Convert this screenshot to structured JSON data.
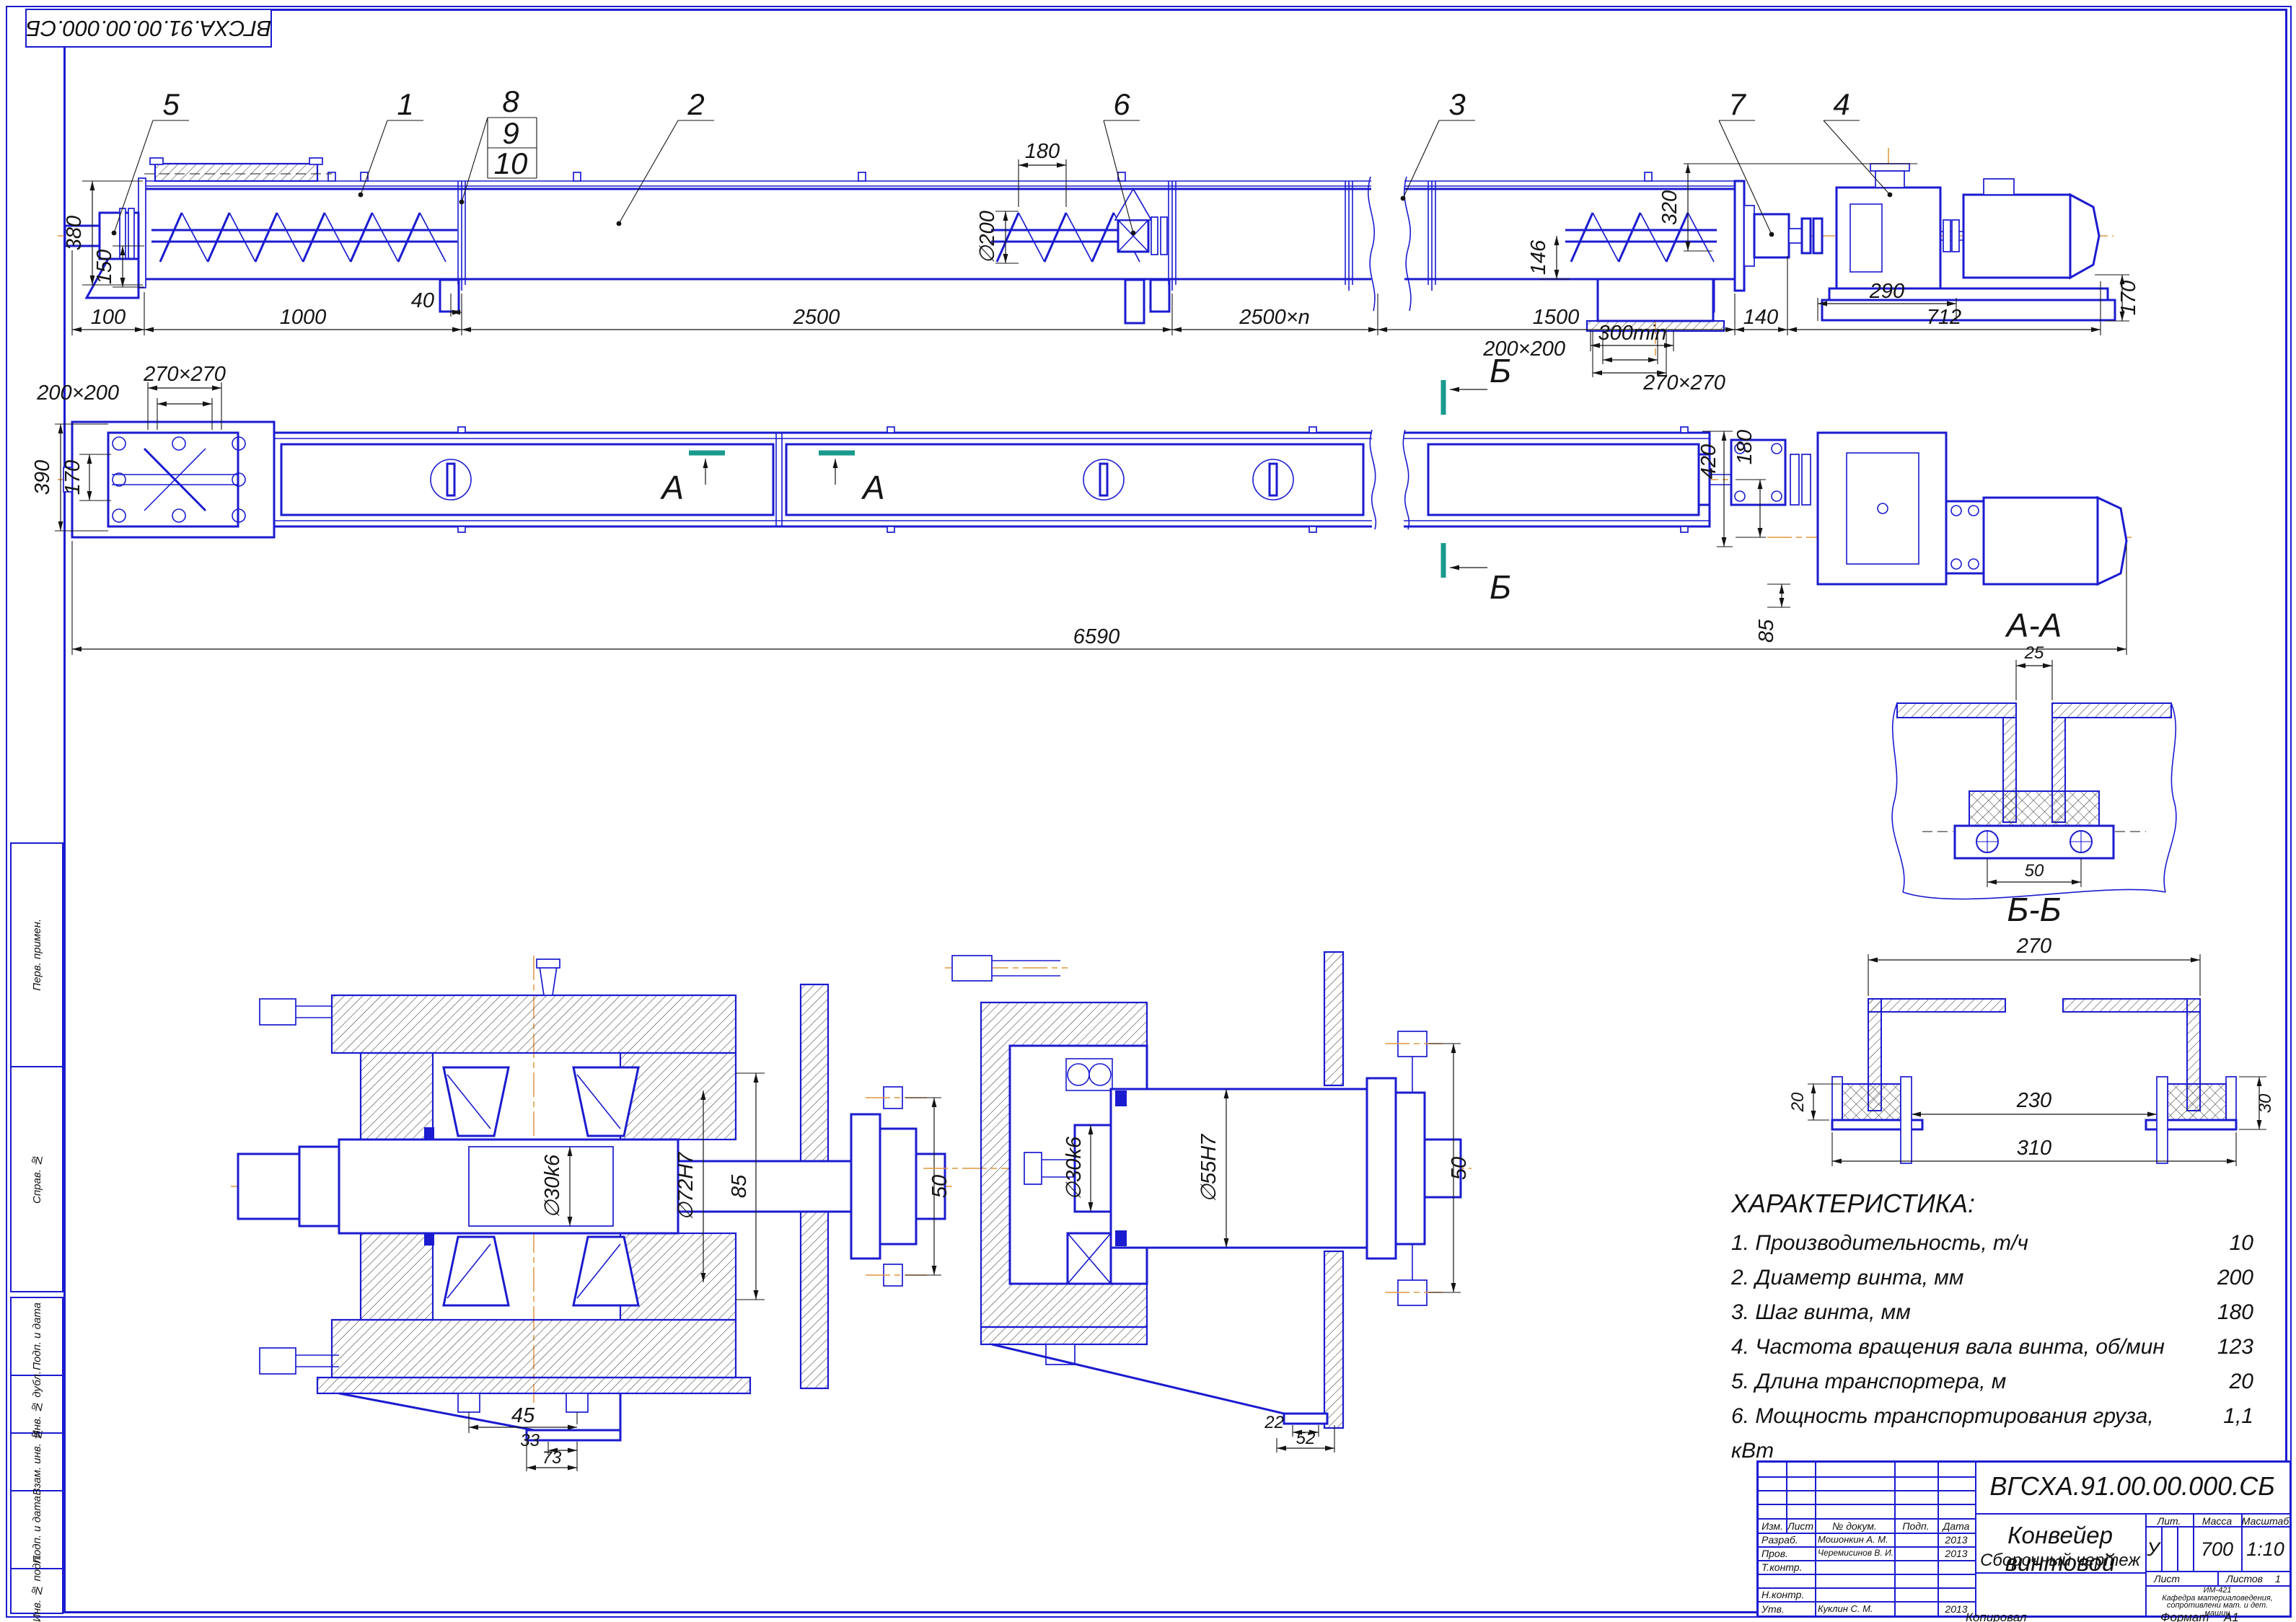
{
  "sheet": {
    "stamp_top_left": "ВГСХА.91.00.00.000.СБ",
    "copied_label": "Копировал",
    "format_label": "Формат",
    "format_value": "А1"
  },
  "margin": {
    "perv": "Перв. примен.",
    "sprav": "Справ. №",
    "podp1": "Подп. и дата",
    "inv_dubl": "Инв. № дубл.",
    "vzam": "Взам. инв. №",
    "podp2": "Подп. и дата",
    "inv_podl": "Инв. № подл."
  },
  "callouts": {
    "c1": "1",
    "c2": "2",
    "c3": "3",
    "c4": "4",
    "c5": "5",
    "c6": "6",
    "c7": "7",
    "c8": "8",
    "c9": "9",
    "c10": "10"
  },
  "sections": {
    "aa_title": "А-А",
    "bb_title": "Б-Б",
    "a_mark": "А",
    "b_mark": "Б"
  },
  "dims": {
    "elevation": {
      "v380": "380",
      "v150": "150",
      "v100": "100",
      "v1000": "1000",
      "v40": "40",
      "v2500": "2500",
      "v2500n": "2500×n",
      "v1500": "1500",
      "v140": "140",
      "v712": "712",
      "v290": "290",
      "v300min": "300min",
      "v200x200": "200×200",
      "v270x270": "270×270",
      "v180": "180",
      "d200": "∅200",
      "v320": "320",
      "v146": "146",
      "v170": "170"
    },
    "plan": {
      "v390": "390",
      "v170": "170",
      "v270x270": "270×270",
      "v200x200": "200×200",
      "v6590": "6590",
      "v420": "420",
      "v180": "180",
      "v85": "85"
    },
    "detail1": {
      "d30": "∅30k6",
      "d72": "∅72H7",
      "v85": "85",
      "v50": "50",
      "v45": "45",
      "v33": "33",
      "v73": "73"
    },
    "detail2": {
      "d30": "∅30k6",
      "d55": "∅55H7",
      "v50": "50",
      "v22": "22",
      "v52": "52"
    },
    "aa": {
      "v25": "25",
      "v50": "50"
    },
    "bb": {
      "v270": "270",
      "v230": "230",
      "v310": "310",
      "v20": "20",
      "v30": "30"
    }
  },
  "characteristics": {
    "title": "ХАРАКТЕРИСТИКА:",
    "items": [
      {
        "text": "1. Производительность, т/ч",
        "value": "10"
      },
      {
        "text": "2. Диаметр винта, мм",
        "value": "200"
      },
      {
        "text": "3. Шаг винта, мм",
        "value": "180"
      },
      {
        "text": "4. Частота вращения вала винта, об/мин",
        "value": "123"
      },
      {
        "text": "5. Длина транспортера, м",
        "value": "20"
      },
      {
        "text": "6. Мощность транспортирования груза, кВт",
        "value": "1,1"
      }
    ]
  },
  "title_block": {
    "doc_number": "ВГСХА.91.00.00.000.СБ",
    "name": "Конвейер винтовой",
    "doc_type": "Сборочный чертеж",
    "col_izm": "Изм.",
    "col_list": "Лист",
    "col_ndok": "№ докум.",
    "col_podp": "Подп.",
    "col_data": "Дата",
    "razrab_label": "Разраб.",
    "razrab_name": "Мошонкин А. М.",
    "razrab_date": "2013",
    "prov_label": "Пров.",
    "prov_name": "Черемисинов В. И.",
    "prov_date": "2013",
    "tkontr_label": "Т.контр.",
    "nkontr_label": "Н.контр.",
    "utv_label": "Утв.",
    "utv_name": "Куклин С. М.",
    "utv_date": "2013",
    "lit_label": "Лит.",
    "lit_value": "У",
    "mass_label": "Масса",
    "mass_value": "700",
    "scale_label": "Масштаб",
    "scale_value": "1:10",
    "sheet_label": "Лист",
    "sheets_label": "Листов",
    "sheets_value": "1",
    "org_line1": "ИМ-421",
    "org_line2": "Кафедра материаловедения,",
    "org_line3": "сопротивлени мат. и дет.",
    "org_line4": "машин"
  }
}
